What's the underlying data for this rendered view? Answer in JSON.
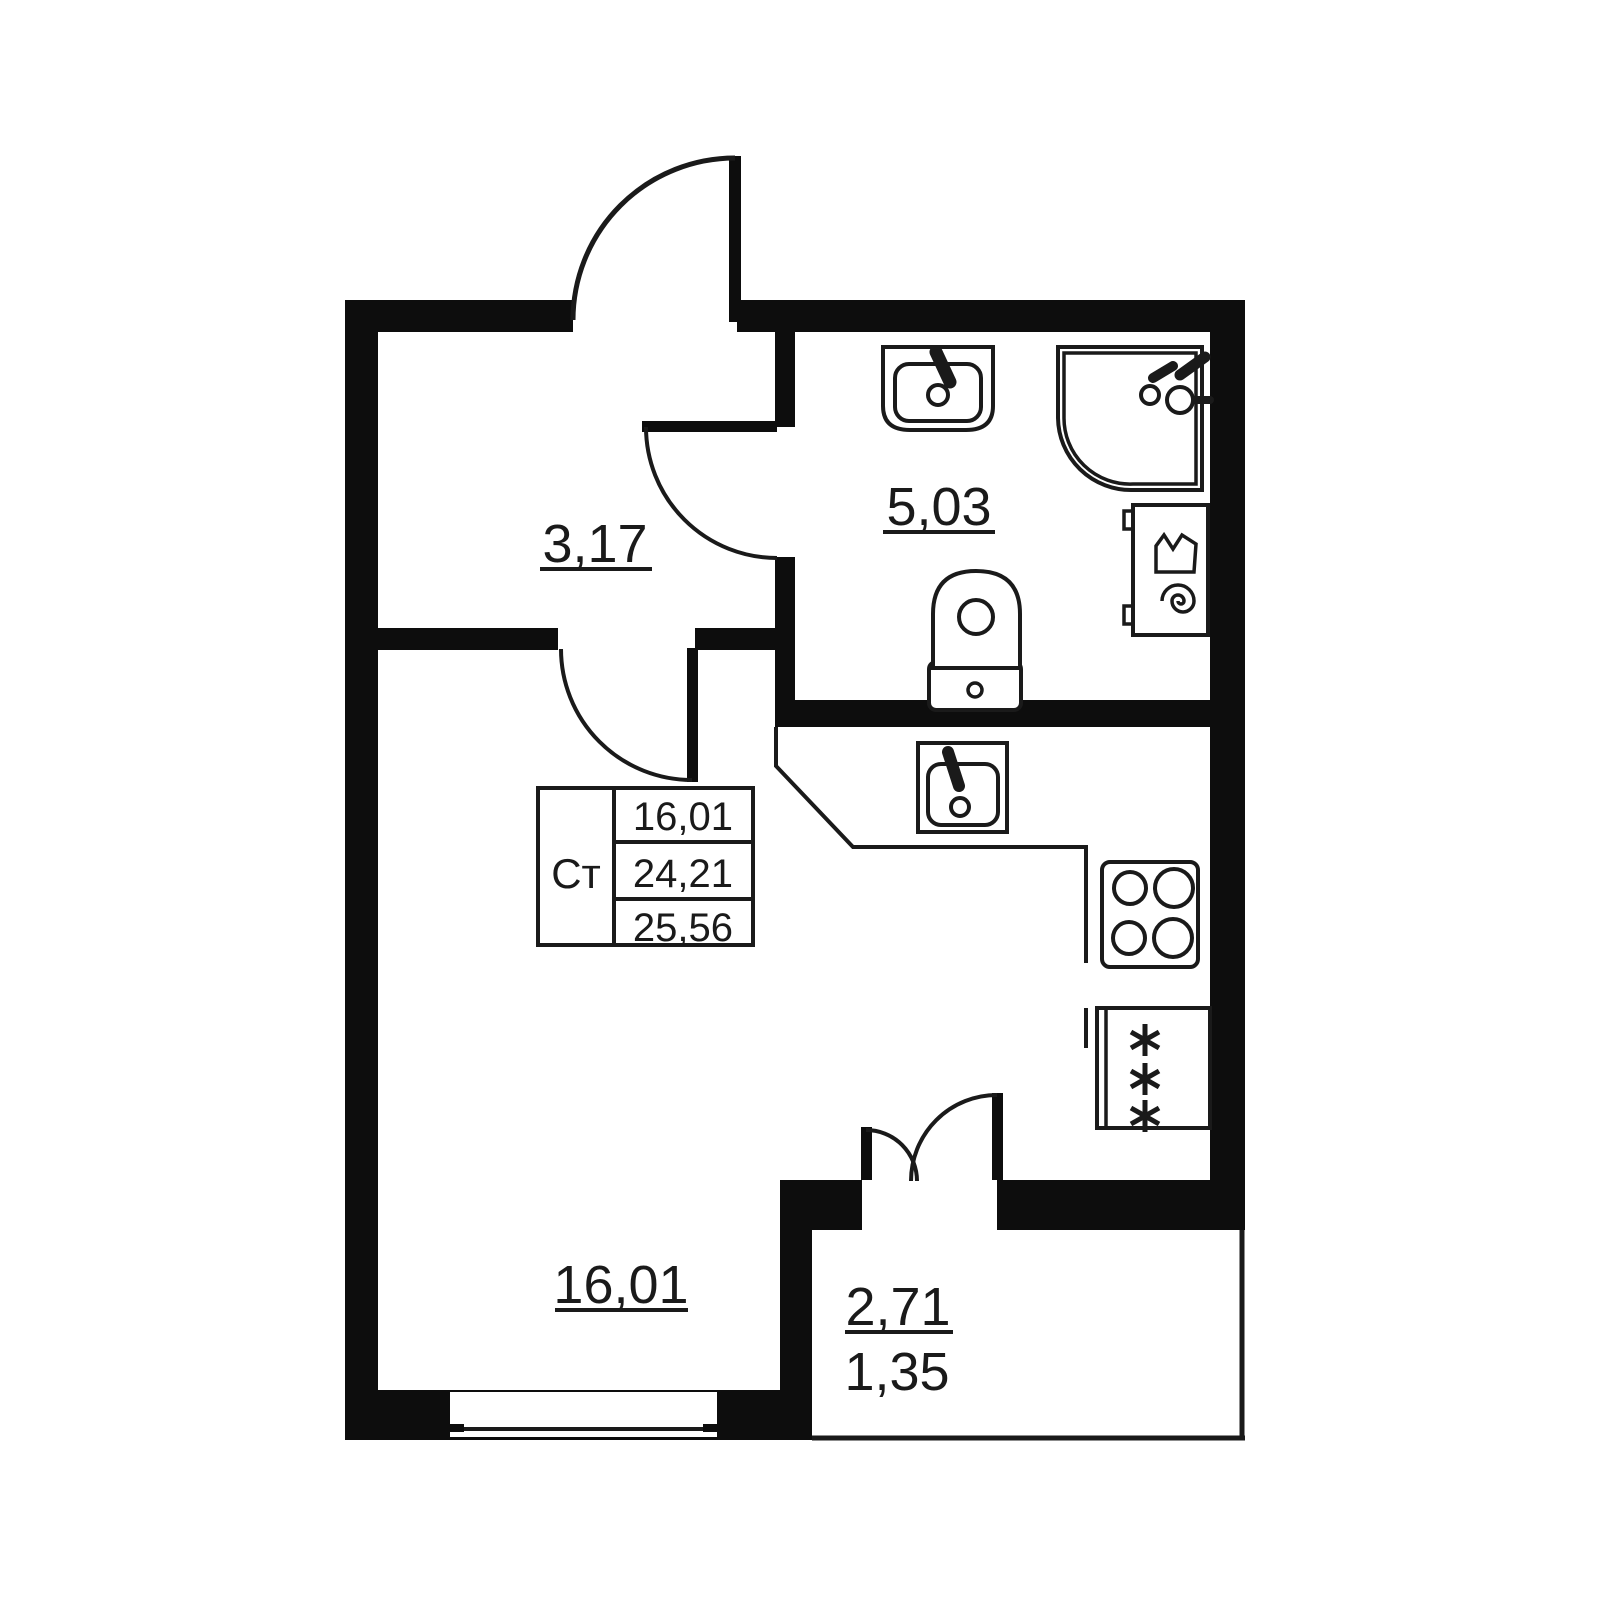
{
  "plan": {
    "unit_table": {
      "type_label": "Ст",
      "living_area": "16,01",
      "total_area": "24,21",
      "total_area_with_balcony": "25,56"
    },
    "room_labels": {
      "hall": "3,17",
      "bathroom": "5,03",
      "living_room": "16,01",
      "balcony": "2,71",
      "balcony_reduced": "1,35"
    }
  },
  "colors": {
    "background": "#ffffff",
    "wall": "#0d0d0d",
    "line": "#1a1a1a"
  }
}
